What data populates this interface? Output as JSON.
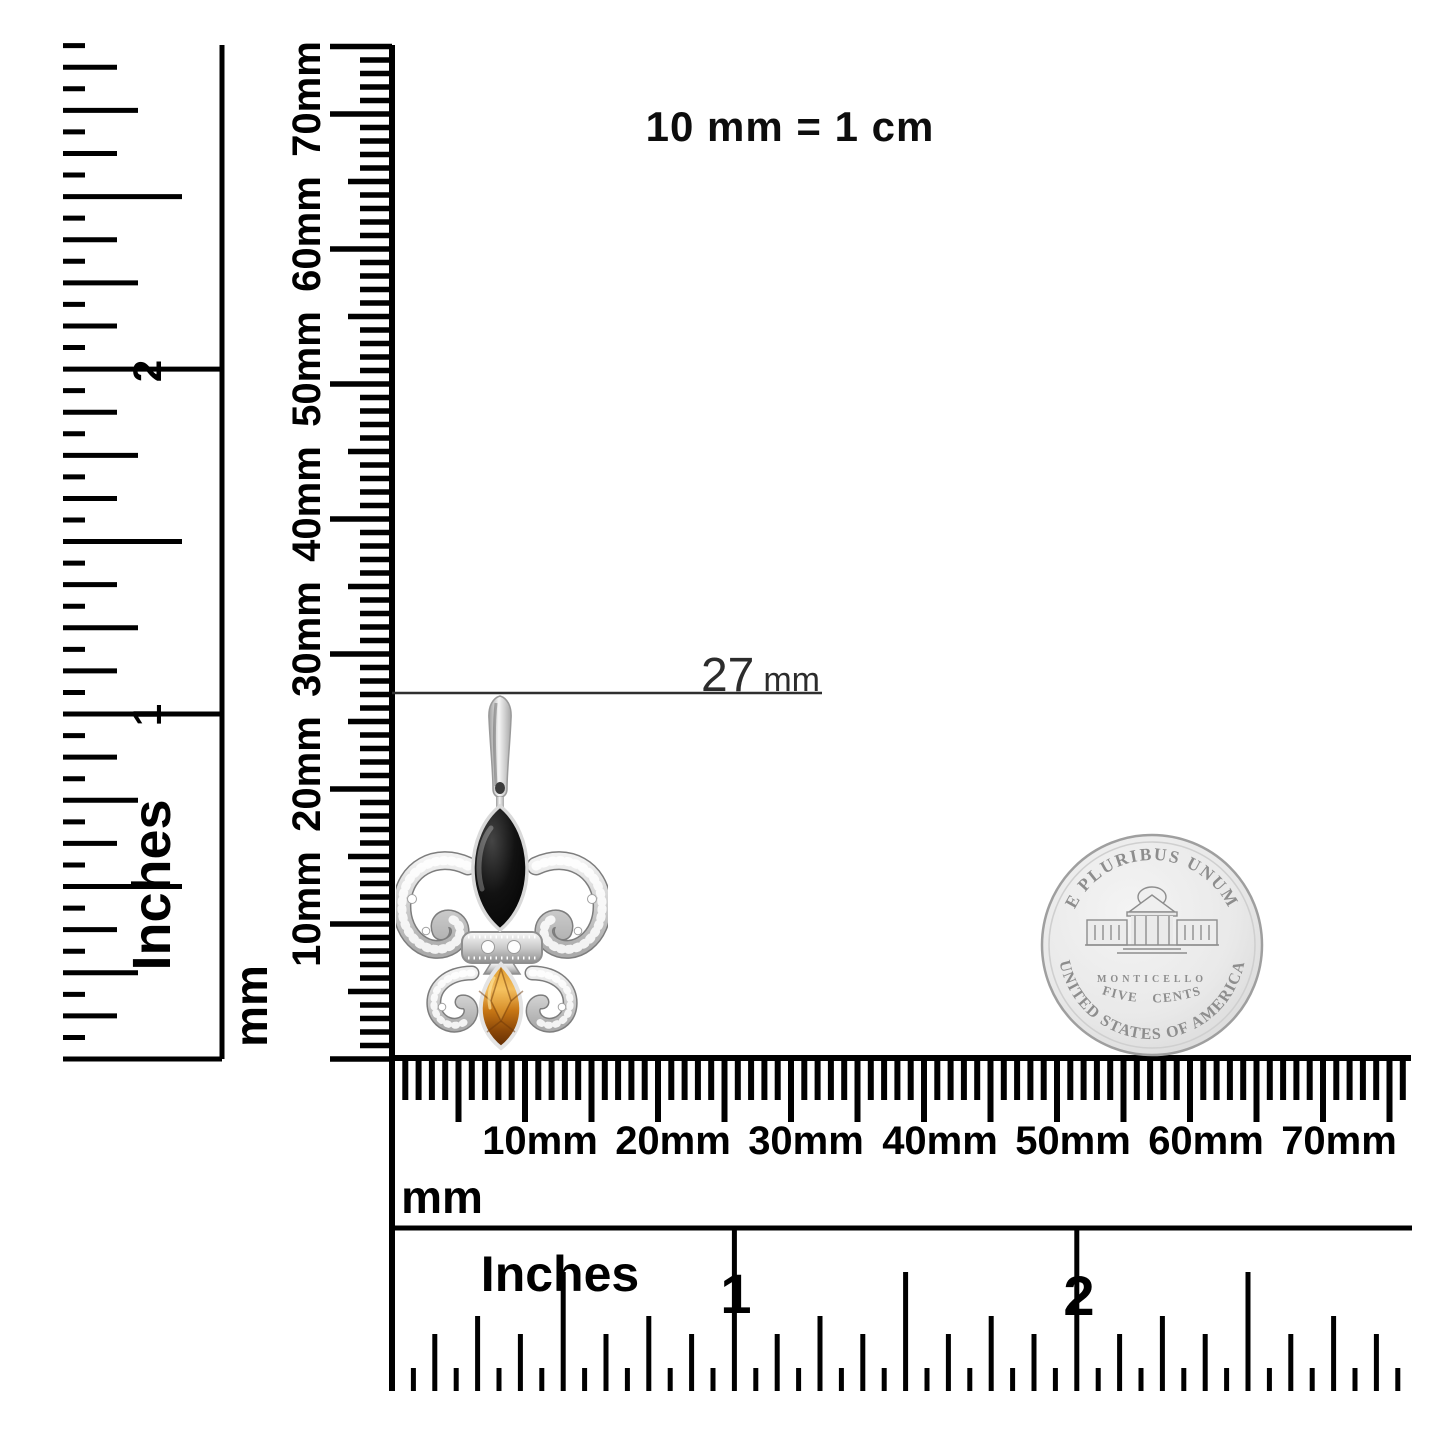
{
  "note": "10 mm = 1 cm",
  "annotation": {
    "value": "27",
    "unit": "mm"
  },
  "rulers": {
    "vertical_inch": {
      "unit": "Inches",
      "labels": [
        "1",
        "2"
      ]
    },
    "vertical_mm": {
      "unit": "mm",
      "labels": [
        "10mm",
        "20mm",
        "30mm",
        "40mm",
        "50mm",
        "60mm",
        "70mm"
      ]
    },
    "horizontal_mm": {
      "unit": "mm",
      "labels": [
        "10mm",
        "20mm",
        "30mm",
        "40mm",
        "50mm",
        "60mm",
        "70mm"
      ]
    },
    "horizontal_inch": {
      "unit": "Inches",
      "labels": [
        "1",
        "2"
      ]
    }
  },
  "coin": {
    "legend_top": "E PLURIBUS UNUM",
    "building": "MONTICELLO",
    "denomination": "FIVE CENTS",
    "legend_bottom": "UNITED STATES OF AMERICA"
  },
  "colors": {
    "ink": "#000000",
    "annotation_line": "#2f2f2f",
    "silver": "#c9c9c9",
    "onyx": "#0a0a0a",
    "citrine": "#c87715"
  }
}
